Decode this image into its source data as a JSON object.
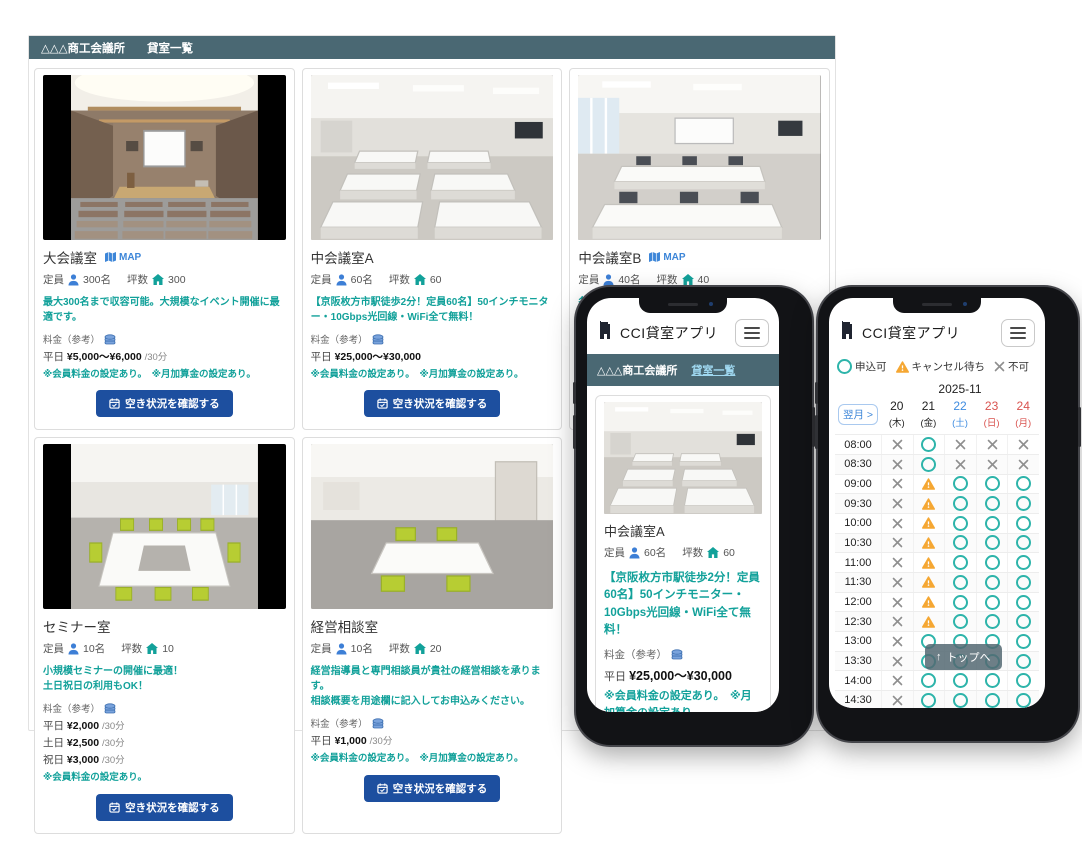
{
  "navbar": {
    "brand": "△△△商工会議所",
    "link": "貸室一覧"
  },
  "labels": {
    "capacity": "定員",
    "area": "坪数",
    "fee": "料金（参考）",
    "check_button": "空き状況を確認する",
    "map": "MAP"
  },
  "colors": {
    "navbar": "#4a6873",
    "teal_text": "#12a19a",
    "button_navy": "#1d4f9f",
    "link_blue": "#3d86d8",
    "saturday": "#3f8ce0",
    "holiday": "#d9534f",
    "available": "#2db4aa",
    "waitlist": "#f5a733",
    "unavailable": "#8f8f8f"
  },
  "cards": [
    {
      "title": "大会議室",
      "map": "MAP",
      "photo": "auditorium",
      "letterbox": true,
      "capacity": "300名",
      "area": "300",
      "description": "最大300名まで収容可能。大規模なイベント開催に最適です。",
      "prices": [
        {
          "label": "平日",
          "value": "¥5,000～¥6,000",
          "unit": "/30分"
        }
      ],
      "notes": "※会員料金の設定あり。　※月加算金の設定あり。"
    },
    {
      "title": "中会議室A",
      "map": "",
      "photo": "classroomA",
      "letterbox": false,
      "capacity": "60名",
      "area": "60",
      "description": "【京阪枚方市駅徒歩2分！定員60名】50インチモニター・10Gbps光回線・WiFi全て無料！",
      "prices": [
        {
          "label": "平日",
          "value": "¥25,000～¥30,000",
          "unit": ""
        }
      ],
      "notes": "※会員料金の設定あり。　※月加算金の設定あり。"
    },
    {
      "title": "中会議室B",
      "map": "MAP",
      "photo": "classroomB",
      "letterbox": false,
      "capacity": "40名",
      "area": "40",
      "description": "各種研修会の開催に最適です。",
      "prices": [
        {
          "label": "平日",
          "value": "",
          "unit": ""
        }
      ],
      "notes": "※会員料金の設定あり。"
    },
    {
      "title": "セミナー室",
      "map": "",
      "photo": "seminar",
      "letterbox": true,
      "capacity": "10名",
      "area": "10",
      "description": "小規模セミナーの開催に最適！\n土日祝日の利用もOK！",
      "prices": [
        {
          "label": "平日",
          "value": "¥2,000",
          "unit": "/30分"
        },
        {
          "label": "土日",
          "value": "¥2,500",
          "unit": "/30分"
        },
        {
          "label": "祝日",
          "value": "¥3,000",
          "unit": "/30分"
        }
      ],
      "notes": "※会員料金の設定あり。"
    },
    {
      "title": "経営相談室",
      "map": "",
      "photo": "consult",
      "letterbox": false,
      "capacity": "10名",
      "area": "20",
      "description": "経営指導員と専門相談員が貴社の経営相談を承ります。\n相談概要を用途欄に記入してお申込みください。",
      "prices": [
        {
          "label": "平日",
          "value": "¥1,000",
          "unit": "/30分"
        }
      ],
      "notes": "※会員料金の設定あり。　※月加算金の設定あり。"
    }
  ],
  "phone_left": {
    "app_title": "CCI貸室アプリ",
    "navbar": {
      "brand": "△△△商工会議所",
      "link": "貸室一覧"
    },
    "card": {
      "title": "中会議室A",
      "map": "",
      "photo": "classroomA",
      "letterbox": false,
      "capacity": "60名",
      "area": "60",
      "description": "【京阪枚方市駅徒歩2分！定員60名】50インチモニター・10Gbps光回線・WiFi全て無料！",
      "prices": [
        {
          "label": "平日",
          "value": "¥25,000～¥30,000",
          "unit": ""
        }
      ],
      "notes": "※会員料金の設定あり。　※月加算金の設定あり。"
    }
  },
  "phone_right": {
    "app_title": "CCI貸室アプリ",
    "legend": [
      {
        "symbol": "ok",
        "label": "申込可"
      },
      {
        "symbol": "wait",
        "label": "キャンセル待ち"
      },
      {
        "symbol": "ng",
        "label": "不可"
      }
    ],
    "calendar": {
      "month": "2025-11",
      "next_button": "翌月 >",
      "days": [
        {
          "date": "20",
          "weekday": "(木)",
          "color": "default"
        },
        {
          "date": "21",
          "weekday": "(金)",
          "color": "default"
        },
        {
          "date": "22",
          "weekday": "(土)",
          "color": "sat"
        },
        {
          "date": "23",
          "weekday": "(日)",
          "color": "hol"
        },
        {
          "date": "24",
          "weekday": "(月)",
          "color": "hol"
        }
      ],
      "rows": [
        {
          "time": "08:00",
          "status": [
            "ng",
            "ok",
            "ng",
            "ng",
            "ng"
          ]
        },
        {
          "time": "08:30",
          "status": [
            "ng",
            "ok",
            "ng",
            "ng",
            "ng"
          ]
        },
        {
          "time": "09:00",
          "status": [
            "ng",
            "wait",
            "ok",
            "ok",
            "ok"
          ]
        },
        {
          "time": "09:30",
          "status": [
            "ng",
            "wait",
            "ok",
            "ok",
            "ok"
          ]
        },
        {
          "time": "10:00",
          "status": [
            "ng",
            "wait",
            "ok",
            "ok",
            "ok"
          ]
        },
        {
          "time": "10:30",
          "status": [
            "ng",
            "wait",
            "ok",
            "ok",
            "ok"
          ]
        },
        {
          "time": "11:00",
          "status": [
            "ng",
            "wait",
            "ok",
            "ok",
            "ok"
          ]
        },
        {
          "time": "11:30",
          "status": [
            "ng",
            "wait",
            "ok",
            "ok",
            "ok"
          ]
        },
        {
          "time": "12:00",
          "status": [
            "ng",
            "wait",
            "ok",
            "ok",
            "ok"
          ]
        },
        {
          "time": "12:30",
          "status": [
            "ng",
            "wait",
            "ok",
            "ok",
            "ok"
          ]
        },
        {
          "time": "13:00",
          "status": [
            "ng",
            "ok",
            "ok",
            "ok",
            "ok"
          ]
        },
        {
          "time": "13:30",
          "status": [
            "ng",
            "ok",
            "ok",
            "ok",
            "ok"
          ]
        },
        {
          "time": "14:00",
          "status": [
            "ng",
            "ok",
            "ok",
            "ok",
            "ok"
          ]
        },
        {
          "time": "14:30",
          "status": [
            "ng",
            "ok",
            "ok",
            "ok",
            "ok"
          ]
        },
        {
          "time": "15:00",
          "status": [
            "ng",
            "ok",
            "ok",
            "ok",
            "ok"
          ]
        }
      ]
    },
    "top_button": {
      "arrow": "↑",
      "label": "トップへ"
    }
  }
}
